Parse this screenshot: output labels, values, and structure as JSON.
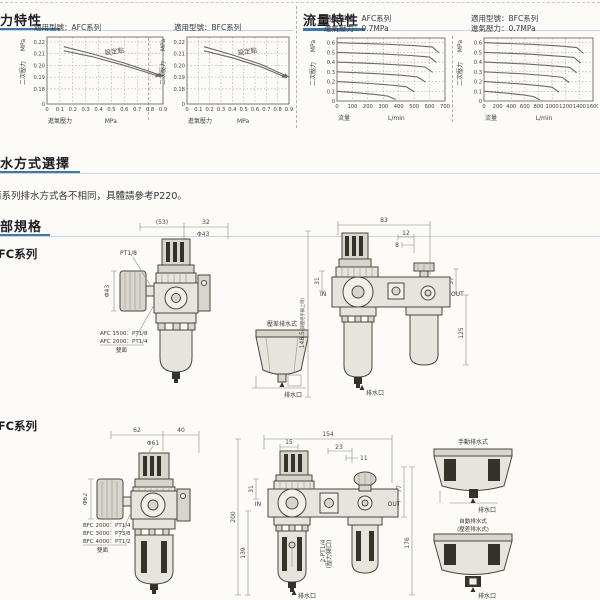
{
  "page": {
    "accent_blue": "#3f77a8",
    "rule_blue": "#c5d6e6"
  },
  "sections": {
    "pressure": {
      "title": "壓力特性"
    },
    "flow": {
      "title": "流量特性"
    },
    "drain": {
      "title": "排水方式選擇",
      "note": "兩系列排水方式各不相同，具體請參考P220。"
    },
    "specs": {
      "title": "外部規格",
      "afc_series_label": "AFC系列",
      "bfc_series_label": "BFC系列"
    }
  },
  "chart_data": [
    {
      "id": "afc-pressure",
      "type": "line",
      "ybreak": true,
      "title": "適用型號：AFC系列",
      "ylabel": "二次壓力",
      "yunit": "MPa",
      "xlabel": "進氣壓力",
      "xunit": "MPa",
      "xticks": [
        0,
        0.1,
        0.2,
        0.3,
        0.4,
        0.5,
        0.6,
        0.7,
        0.8,
        0.9
      ],
      "yticks": [
        0.18,
        0.19,
        0.2,
        0.21,
        0.22
      ],
      "origin_label": "0",
      "annotation": "設定點",
      "series": [
        {
          "name": "設定點上限",
          "points": [
            [
              0.13,
              0.216
            ],
            [
              0.35,
              0.21
            ],
            [
              0.6,
              0.202
            ],
            [
              0.9,
              0.191
            ]
          ]
        },
        {
          "name": "設定點下限",
          "points": [
            [
              0.13,
              0.2125
            ],
            [
              0.35,
              0.2075
            ],
            [
              0.6,
              0.2
            ],
            [
              0.88,
              0.1905
            ]
          ]
        }
      ]
    },
    {
      "id": "bfc-pressure",
      "type": "line",
      "ybreak": true,
      "title": "適用型號：BFC系列",
      "ylabel": "二次壓力",
      "yunit": "MPa",
      "xlabel": "進氣壓力",
      "xunit": "MPa",
      "xticks": [
        0,
        0.1,
        0.2,
        0.3,
        0.4,
        0.5,
        0.6,
        0.7,
        0.8,
        0.9
      ],
      "yticks": [
        0.18,
        0.19,
        0.2,
        0.21,
        0.22
      ],
      "origin_label": "0",
      "annotation": "設定點",
      "series": [
        {
          "name": "設定點上限",
          "points": [
            [
              0.15,
              0.216
            ],
            [
              0.4,
              0.209
            ],
            [
              0.65,
              0.201
            ],
            [
              0.9,
              0.19
            ]
          ]
        },
        {
          "name": "設定點下限",
          "points": [
            [
              0.15,
              0.2125
            ],
            [
              0.4,
              0.2065
            ],
            [
              0.65,
              0.199
            ],
            [
              0.88,
              0.1895
            ]
          ]
        }
      ]
    },
    {
      "id": "afc-flow",
      "type": "line",
      "ybreak": false,
      "title": "適用型號：AFC系列",
      "subtitle": "進氣壓力：0.7MPa",
      "ylabel": "二次壓力",
      "yunit": "MPa",
      "xlabel": "流量",
      "xunit": "L/min",
      "xticks": [
        0,
        100,
        200,
        300,
        400,
        500,
        600,
        700
      ],
      "yticks": [
        0.1,
        0.2,
        0.3,
        0.4,
        0.5,
        0.6
      ],
      "origin_label": "0",
      "series": [
        {
          "name": "0.6MPa",
          "points": [
            [
              0,
              0.6
            ],
            [
              300,
              0.585
            ],
            [
              500,
              0.57
            ],
            [
              620,
              0.555
            ],
            [
              660,
              0.495
            ]
          ]
        },
        {
          "name": "0.5MPa",
          "points": [
            [
              0,
              0.5
            ],
            [
              300,
              0.483
            ],
            [
              480,
              0.468
            ],
            [
              600,
              0.452
            ],
            [
              645,
              0.395
            ]
          ]
        },
        {
          "name": "0.4MPa",
          "points": [
            [
              0,
              0.4
            ],
            [
              280,
              0.382
            ],
            [
              460,
              0.366
            ],
            [
              570,
              0.35
            ],
            [
              620,
              0.295
            ]
          ]
        },
        {
          "name": "0.3MPa",
          "points": [
            [
              0,
              0.3
            ],
            [
              260,
              0.281
            ],
            [
              420,
              0.264
            ],
            [
              520,
              0.248
            ],
            [
              575,
              0.195
            ]
          ]
        },
        {
          "name": "0.2MPa",
          "points": [
            [
              0,
              0.2
            ],
            [
              220,
              0.18
            ],
            [
              360,
              0.162
            ],
            [
              450,
              0.146
            ],
            [
              500,
              0.095
            ]
          ]
        },
        {
          "name": "0.1MPa",
          "points": [
            [
              0,
              0.1
            ],
            [
              150,
              0.082
            ],
            [
              260,
              0.065
            ],
            [
              330,
              0.05
            ],
            [
              380,
              0.015
            ]
          ]
        }
      ]
    },
    {
      "id": "bfc-flow",
      "type": "line",
      "ybreak": false,
      "title": "適用型號：BFC系列",
      "subtitle": "進氣壓力：0.7MPa",
      "ylabel": "二次壓力",
      "yunit": "MPa",
      "xlabel": "流量",
      "xunit": "L/min",
      "xticks": [
        0,
        200,
        400,
        600,
        800,
        1000,
        1200,
        1400,
        1600
      ],
      "yticks": [
        0.1,
        0.2,
        0.3,
        0.4,
        0.5,
        0.6
      ],
      "origin_label": "0",
      "series": [
        {
          "name": "0.6MPa",
          "points": [
            [
              0,
              0.6
            ],
            [
              700,
              0.583
            ],
            [
              1100,
              0.566
            ],
            [
              1360,
              0.55
            ],
            [
              1460,
              0.49
            ]
          ]
        },
        {
          "name": "0.5MPa",
          "points": [
            [
              0,
              0.5
            ],
            [
              680,
              0.481
            ],
            [
              1050,
              0.464
            ],
            [
              1320,
              0.448
            ],
            [
              1420,
              0.39
            ]
          ]
        },
        {
          "name": "0.4MPa",
          "points": [
            [
              0,
              0.4
            ],
            [
              640,
              0.38
            ],
            [
              1000,
              0.362
            ],
            [
              1260,
              0.345
            ],
            [
              1360,
              0.29
            ]
          ]
        },
        {
          "name": "0.3MPa",
          "points": [
            [
              0,
              0.3
            ],
            [
              580,
              0.279
            ],
            [
              920,
              0.261
            ],
            [
              1150,
              0.243
            ],
            [
              1250,
              0.19
            ]
          ]
        },
        {
          "name": "0.2MPa",
          "points": [
            [
              0,
              0.2
            ],
            [
              500,
              0.178
            ],
            [
              800,
              0.159
            ],
            [
              1000,
              0.142
            ],
            [
              1100,
              0.09
            ]
          ]
        },
        {
          "name": "0.1MPa",
          "points": [
            [
              0,
              0.1
            ],
            [
              340,
              0.08
            ],
            [
              580,
              0.062
            ],
            [
              730,
              0.045
            ],
            [
              820,
              0.012
            ]
          ]
        }
      ]
    }
  ],
  "drawings": {
    "afc_side": {
      "dim_w_body": "(53)",
      "dim_w_knob": "32",
      "dim_knob_dia": "Φ43",
      "dim_gauge_dia": "Φ43",
      "port_label": "PT1/8",
      "notes": [
        "AFC 1500：PT1/8",
        "AFC 2000：PT1/4",
        "雙面"
      ]
    },
    "afc_drain": {
      "label": "壓差排水式",
      "drain": "排水口"
    },
    "afc_front": {
      "dim_w": "83",
      "dim_a": "12",
      "dim_b": "8",
      "dim_left": "31",
      "dim_right": "37",
      "dim_h": "125",
      "dim_total": "148.5",
      "dim_total_note": "(調壓把手鎖上時)",
      "in": "IN",
      "out": "OUT",
      "drain": "排水口"
    },
    "bfc_side": {
      "dim_w_body": "62",
      "dim_w_knob": "40",
      "dim_knob_dia": "Φ61",
      "dim_gauge_dia": "Φ62",
      "notes": [
        "BFC 2000：PT1/4",
        "BFC 3000：PT3/8",
        "BFC 4000：PT1/2",
        "雙面"
      ]
    },
    "bfc_front": {
      "dim_w": "154",
      "dim_a": "15",
      "dim_b": "23",
      "dim_c": "11",
      "dim_left": "31",
      "dim_right": "77",
      "dim_h": "200",
      "dim_h2": "139",
      "dim_h3": "176",
      "gauge_ports": "2-PT1/4",
      "gauge_ports_note": "(壓力錶口)",
      "in": "IN",
      "out": "OUT",
      "drain": "排水口"
    },
    "drain_cups": {
      "manual": {
        "label": "手動排水式",
        "drain": "排水口"
      },
      "auto": {
        "label": "自動排水式",
        "label2": "(壓差排水式)",
        "drain": "排水口"
      }
    }
  }
}
